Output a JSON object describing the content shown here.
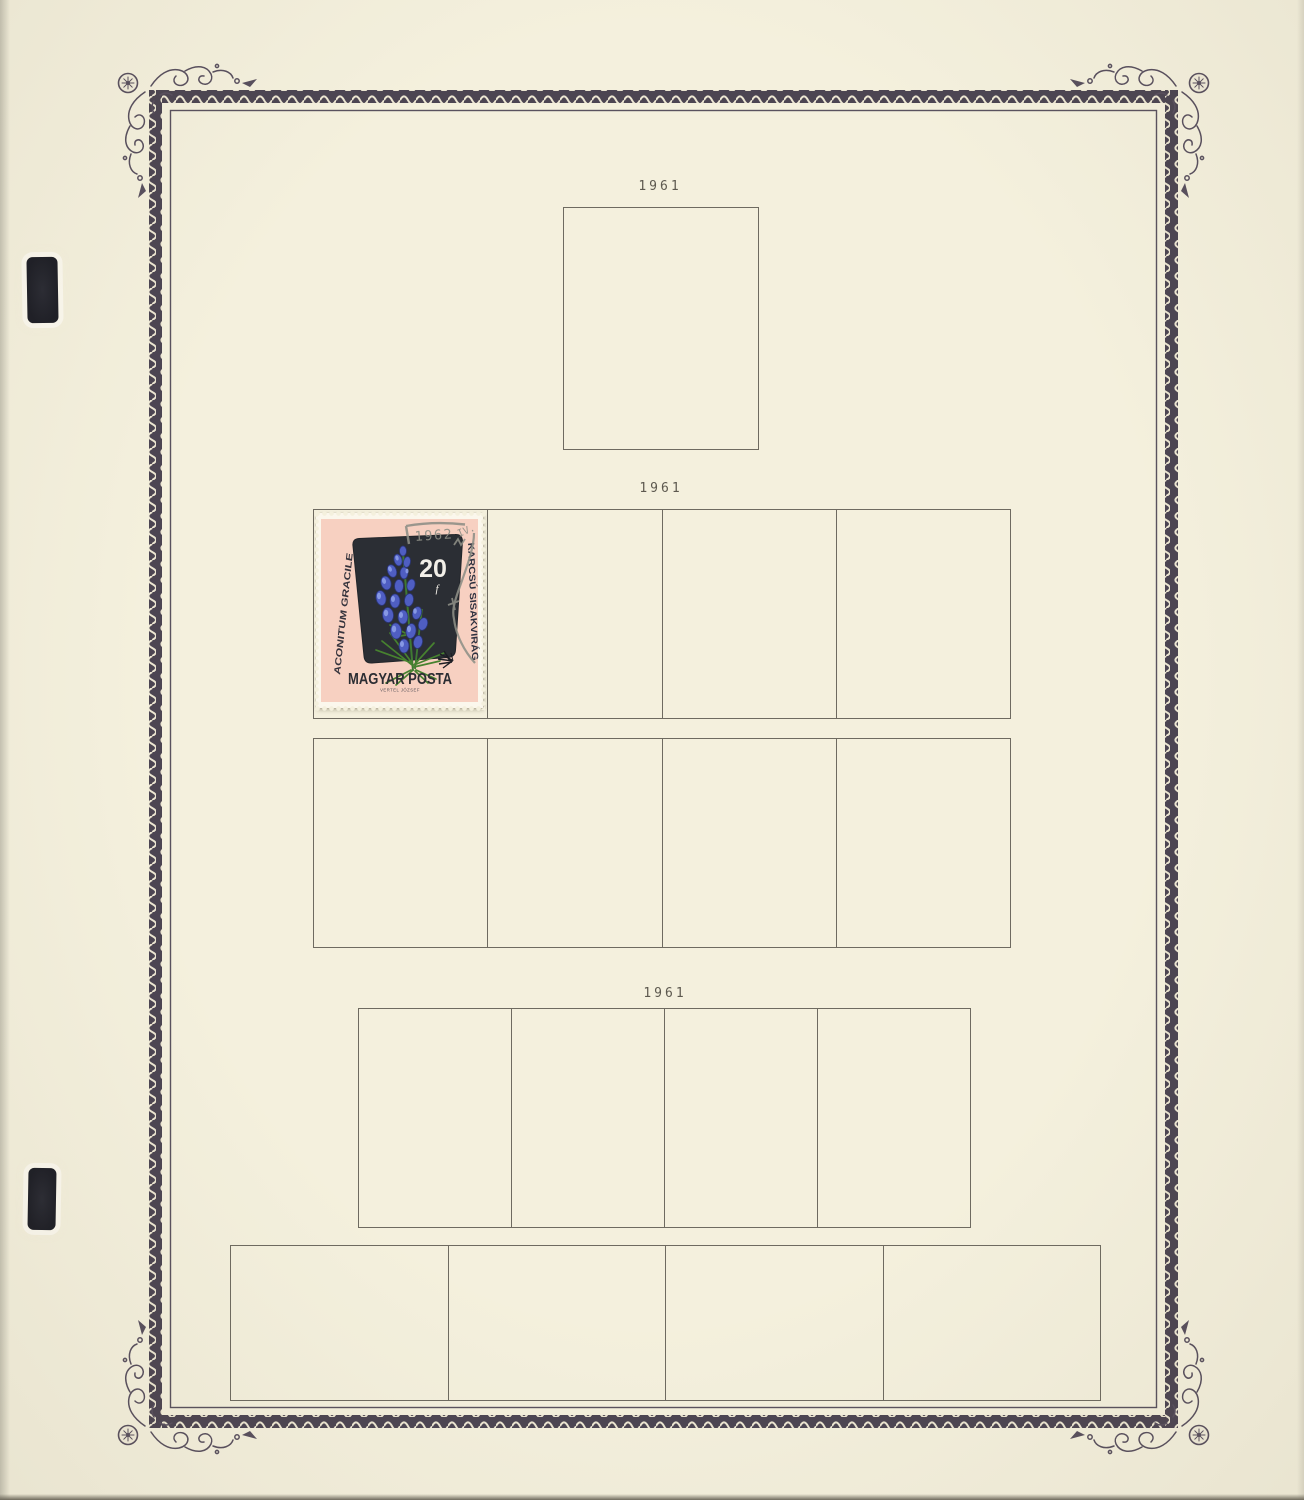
{
  "page": {
    "kind": "stamp album page",
    "background_color": "#f4f0dd",
    "border_band_color": "#4c4552",
    "grid_line_color": "#6e6a60"
  },
  "years": [
    "1961",
    "1961",
    "1961"
  ],
  "stamp": {
    "country": "MAGYAR POSTA",
    "denomination": "20",
    "denomination_unit": "f",
    "species_latin": "ACONITUM GRACILE",
    "species_hungarian": "KARCSÚ SISAKVIRÁG",
    "imprint": "VERTEL JÓZSEF",
    "postmark_year": "1962",
    "postmark_month": "IV.",
    "colors": {
      "paper_white": "#fbf7ec",
      "field_pink": "#f7d0c1",
      "panel_dark": "#2b2e34",
      "flower_blue": "#4f5ec2",
      "leaf_green": "#3f7a33",
      "postmark_gray": "#8e8f86"
    }
  }
}
